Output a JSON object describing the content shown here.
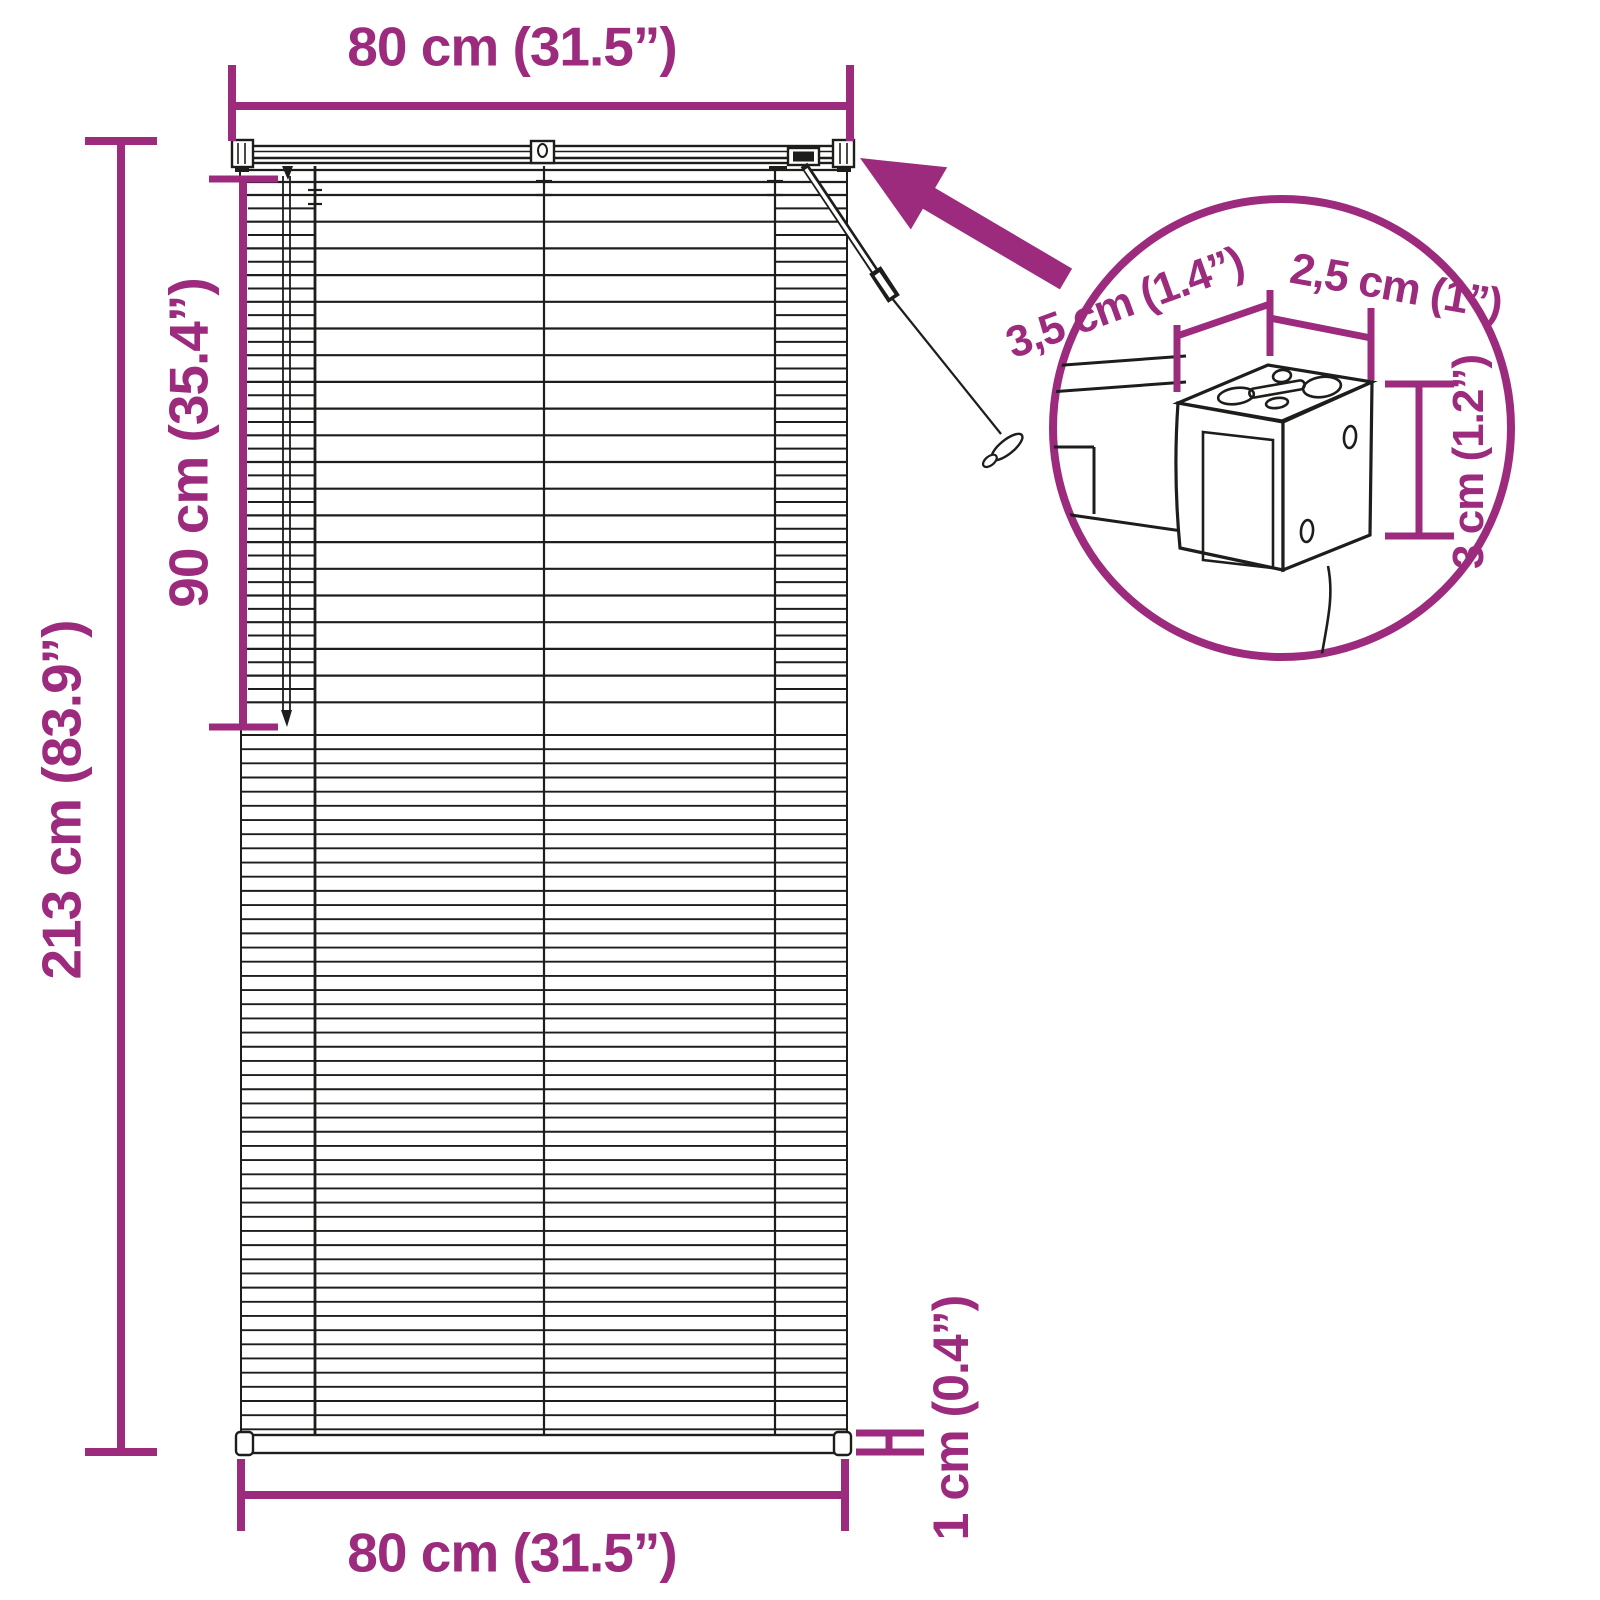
{
  "colors": {
    "accent": "#9c2b7e",
    "line": "#1d1d1b",
    "background": "#ffffff"
  },
  "labels": {
    "width_top": "80 cm (31.5”)",
    "height_total": "213 cm (83.9”)",
    "height_upper": "90 cm (35.4”)",
    "width_bottom": "80 cm (31.5”)",
    "bottom_rail_thickness": "1 cm (0.4”)",
    "inset_depth": "3,5 cm (1.4”)",
    "inset_width": "2,5 cm (1”)",
    "inset_height": "3 cm (1.2”)"
  }
}
